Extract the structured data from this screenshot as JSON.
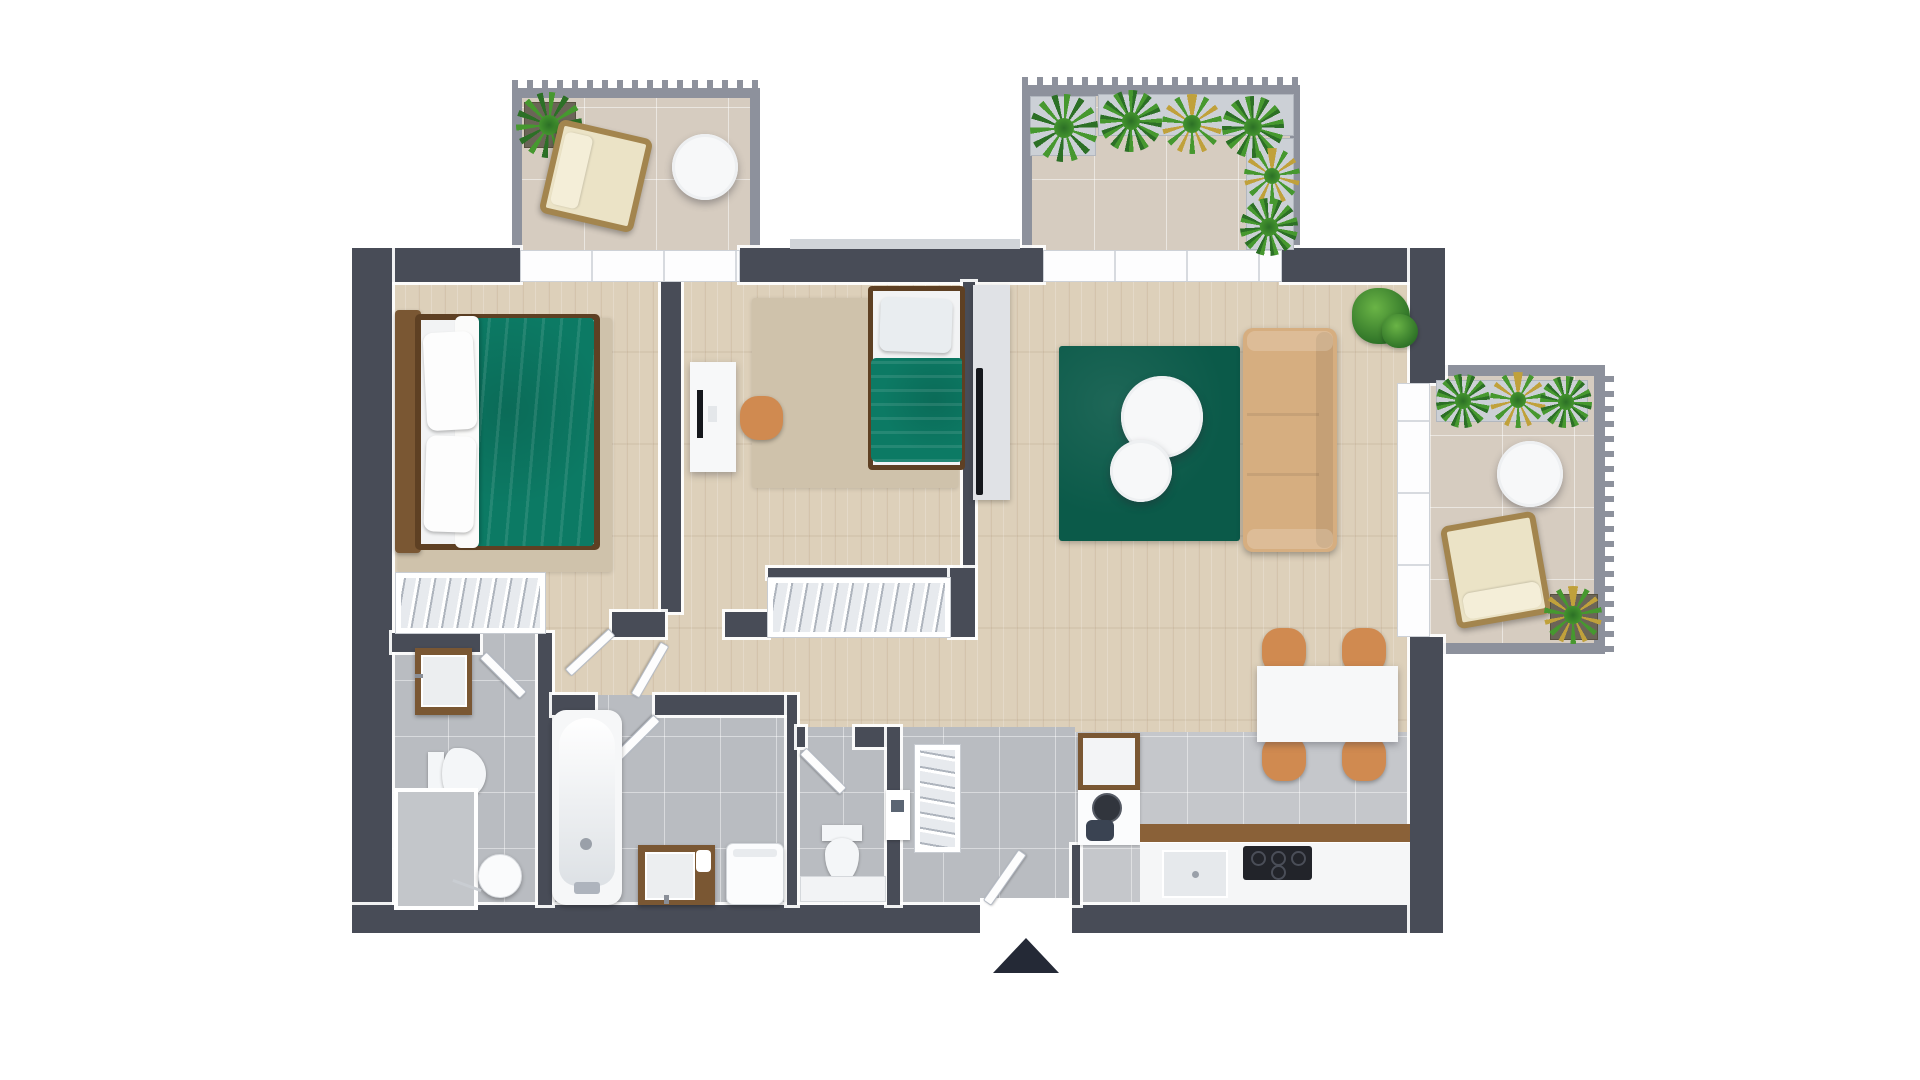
{
  "image_type": "3d-apartment-floor-plan-top-view",
  "visible_text": [],
  "palette": {
    "wall": "#484c57",
    "balcony_wall": "#8d919c",
    "sill": "#d0d4d9",
    "wood": "#ddd0ba",
    "tile": "#b9bcc1",
    "tile_kitchen": "#c5c7cb",
    "tile_outdoor": "#d6ccc0",
    "rug": "#0b5a49",
    "rug_beige": "#cfc2ab",
    "bed_green": "#0c7a64",
    "sofa": "#d6ae80",
    "chair": "#d08a50",
    "brown": "#7a5733",
    "brown_dark": "#5e4023",
    "white_furn": "#f7f8f9",
    "gray_unit": "#e0e2e6",
    "tv": "#15171c",
    "counter_edge": "#8a6138",
    "cooktop": "#22242a",
    "arrow": "#242936",
    "plant": "#46982f",
    "plant_dark": "#2c7026",
    "plant_yellow": "#c0a13b",
    "wicker": "#a3854e",
    "cushion": "#ebe3c6"
  },
  "inventory": {
    "bedroom_1": [
      "double-bed",
      "area-rug",
      "open-wardrobe"
    ],
    "bedroom_2": [
      "single-bed",
      "desk-with-monitor",
      "stool",
      "area-rug",
      "window-sill"
    ],
    "living_dining": [
      "tv-console",
      "tv",
      "sofa",
      "green-rug",
      "coffee-table-large",
      "coffee-table-small",
      "potted-bush",
      "dining-table",
      "dining-chairs-x4"
    ],
    "kitchen": [
      "tall-cabinet",
      "kettle",
      "pot",
      "counter",
      "sink",
      "cooktop"
    ],
    "wc_1": [
      "vanity-sink",
      "toilet",
      "alcove",
      "round-stand"
    ],
    "bathroom": [
      "bathtub",
      "vanity-sink",
      "towels",
      "washing-machine"
    ],
    "wc_2": [
      "toilet",
      "radiator-bench",
      "wall-shelf"
    ],
    "hallway": [
      "coat-wardrobe",
      "entry-wardrobe",
      "interior-doors-x5"
    ],
    "entrance": [
      "entry-door",
      "direction-arrow"
    ],
    "balcony_top_left": [
      "planter",
      "lounge-chair",
      "round-table"
    ],
    "terrace_top_right": [
      "planters",
      "palms",
      "ferns"
    ],
    "balcony_right": [
      "planter",
      "round-table",
      "lounge-chair",
      "potted-plant"
    ]
  }
}
